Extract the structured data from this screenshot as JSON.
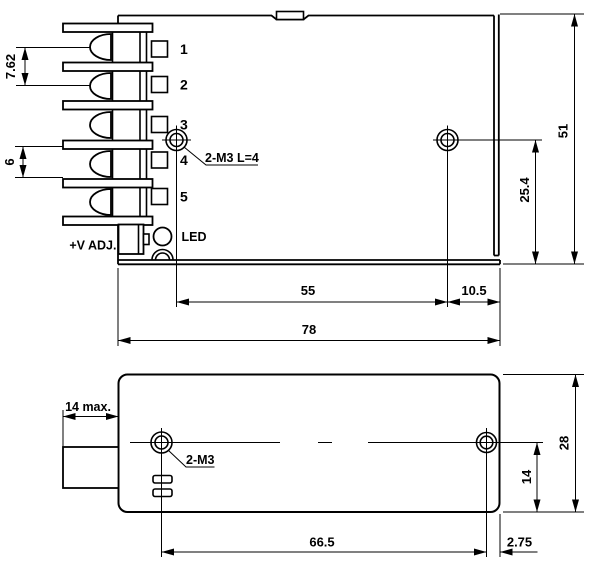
{
  "top_view": {
    "terminal_labels": [
      "1",
      "2",
      "3",
      "4",
      "5"
    ],
    "pot_label": "+V ADJ.",
    "led_label": "LED",
    "mounting_hole_callout": "2-M3 L=4",
    "dim_terminal_pitch_upper": "7.62",
    "dim_terminal_pitch_lower": "6",
    "dim_case_height": "51",
    "dim_hole_to_base": "25.4",
    "dim_hole_spacing": "55",
    "dim_hole_to_edge": "10.5",
    "dim_case_width": "78"
  },
  "bottom_view": {
    "mounting_hole_callout": "2-M3",
    "dim_terminal_depth": "14 max.",
    "dim_hole_spacing": "66.5",
    "dim_hole_to_edge": "2.75",
    "dim_case_depth": "28",
    "dim_hole_to_base": "14"
  }
}
